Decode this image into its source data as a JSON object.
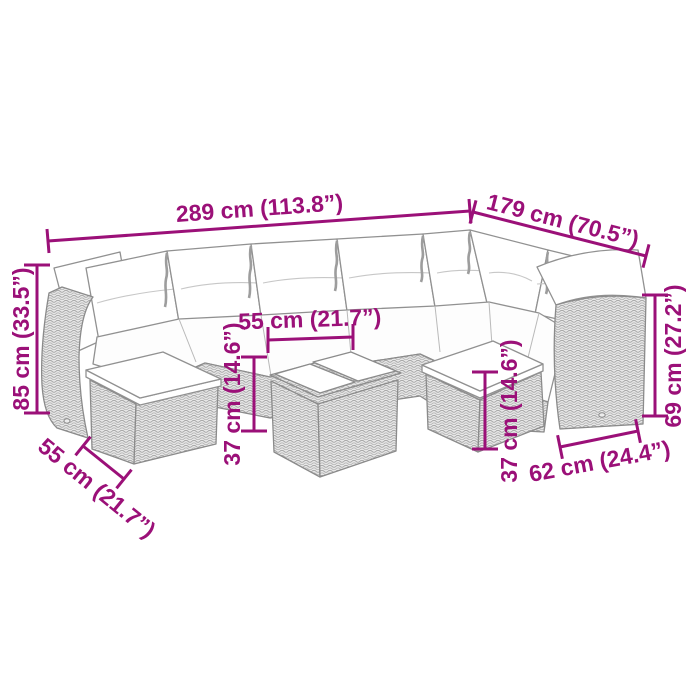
{
  "title": "Rattan garden sofa set dimension diagram",
  "colors": {
    "accent_magenta": "#9b1078",
    "line_art_gray": "#8b8b8b",
    "background": "#ffffff"
  },
  "dims": {
    "sofa_width": "289 cm (113.8”)",
    "sofa_depth": "179 cm (70.5”)",
    "sofa_height": "85 cm (33.5”)",
    "table_top_width": "55 cm (21.7”)",
    "table_height": "37 cm (14.6”)",
    "stool_top_width": "55 cm (21.7”)",
    "stool_height": "37 cm (14.6”)",
    "stool_depth": "62 cm (24.4”)",
    "armrest_height": "69 cm (27.2”)"
  }
}
